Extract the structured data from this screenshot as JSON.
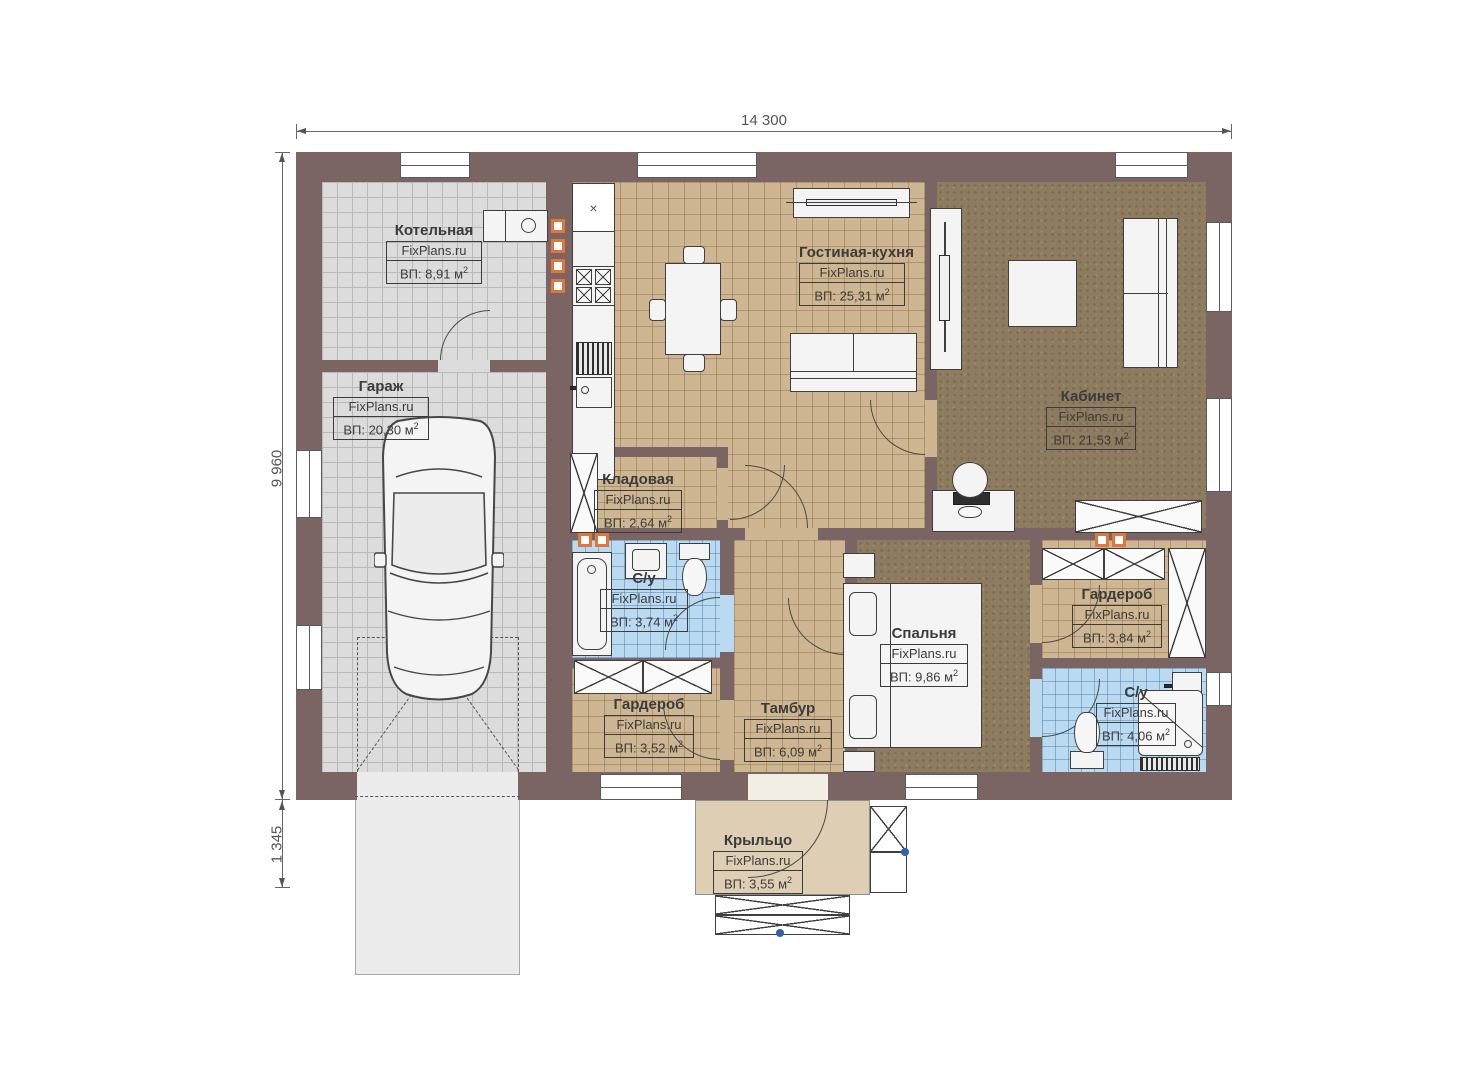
{
  "watermark": "FixPlans.ru",
  "sup": "2",
  "dims": {
    "top": "14 300",
    "left": "9 960",
    "left_lower": "1 345"
  },
  "rooms": [
    {
      "name": "Котельная",
      "area": "ВП: 8,91 м"
    },
    {
      "name": "Гараж",
      "area": "ВП: 20,30 м"
    },
    {
      "name": "Гостиная-кухня",
      "area": "ВП: 25,31 м"
    },
    {
      "name": "Кабинет",
      "area": "ВП: 21,53 м"
    },
    {
      "name": "Кладовая",
      "area": "ВП: 2,64 м"
    },
    {
      "name": "С/у",
      "area": "ВП: 3,74 м"
    },
    {
      "name": "Гардероб",
      "area": "ВП: 3,52 м"
    },
    {
      "name": "Тамбур",
      "area": "ВП: 6,09 м"
    },
    {
      "name": "Спальня",
      "area": "ВП: 9,86 м"
    },
    {
      "name": "Гардероб",
      "area": "ВП: 3,84 м"
    },
    {
      "name": "С/у",
      "area": "ВП: 4,06 м"
    },
    {
      "name": "Крыльцо",
      "area": "ВП: 3,55 м"
    }
  ],
  "symbols": {
    "fridge_x": "×"
  },
  "colors": {
    "wall": "#7b6464",
    "floor_gray": "#dcdcdc",
    "floor_tan": "#cdb691",
    "floor_brown": "#8d7c60",
    "floor_blue": "#badaf1",
    "porch": "#decfb4",
    "vent_orange": "#e0763a"
  }
}
